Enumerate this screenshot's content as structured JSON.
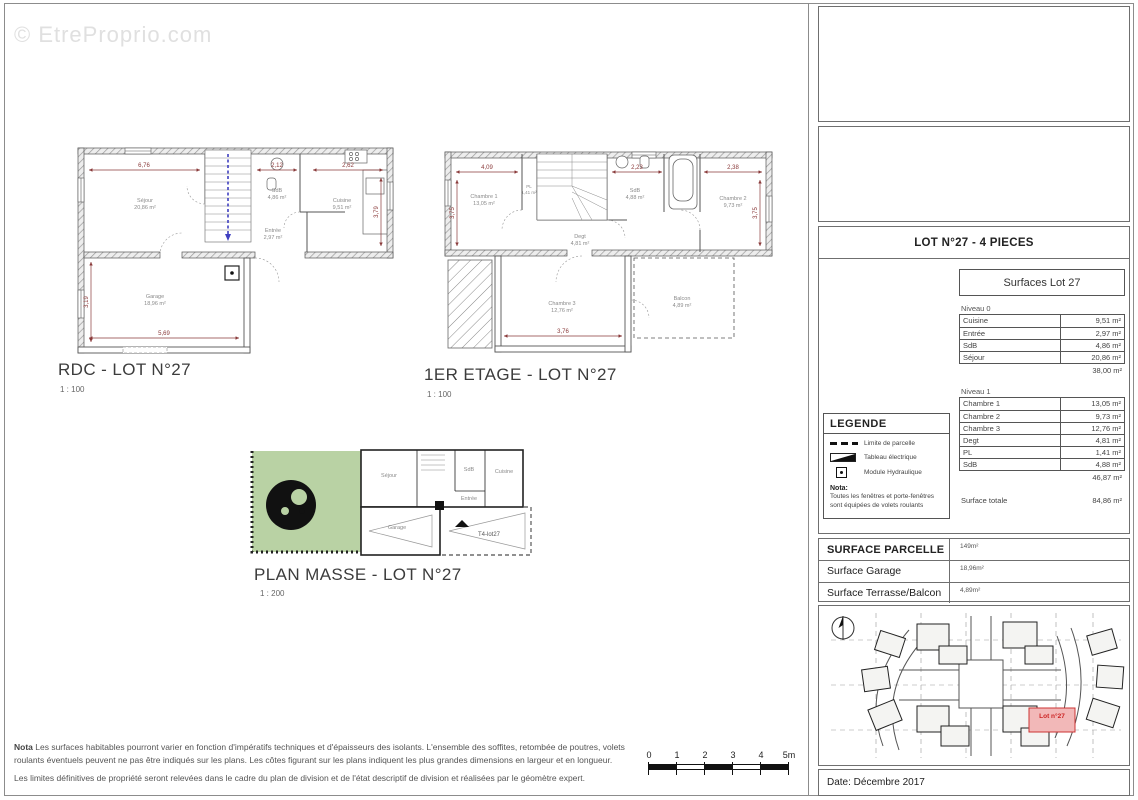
{
  "watermark": "© EtreProprio.com",
  "colors": {
    "dimension_accent": "#8a3a3a",
    "stairs_accent": "#3f3fc0",
    "garden_green": "#b9d2a4",
    "lot_highlight_fill": "#f2b8b8",
    "lot_highlight_text": "#cc2222",
    "wall_gray": "#9a9a9a"
  },
  "plans": {
    "rdc": {
      "title": "RDC - LOT N°27",
      "scale": "1 : 100",
      "rooms": [
        {
          "name": "Séjour",
          "area": "20,86 m²"
        },
        {
          "name": "SdB",
          "area": "4,86 m²"
        },
        {
          "name": "Entrée",
          "area": "2,97 m²"
        },
        {
          "name": "Cuisine",
          "area": "9,51 m²"
        },
        {
          "name": "Garage",
          "area": "18,96 m²"
        }
      ],
      "dims": [
        "6,76",
        "2,12",
        "2,62",
        "3,79",
        "3,19",
        "5,69"
      ]
    },
    "etage": {
      "title": "1ER ETAGE - LOT N°27",
      "scale": "1 : 100",
      "rooms": [
        {
          "name": "Chambre 1",
          "area": "13,05 m²"
        },
        {
          "name": "PL",
          "area": "1,41 m²"
        },
        {
          "name": "SdB",
          "area": "4,88 m²"
        },
        {
          "name": "Chambre 2",
          "area": "9,73 m²"
        },
        {
          "name": "Degt",
          "area": "4,81 m²"
        },
        {
          "name": "Chambre 3",
          "area": "12,76 m²"
        },
        {
          "name": "Balcon",
          "area": "4,89 m²"
        }
      ],
      "dims": [
        "4,09",
        "2,23",
        "2,38",
        "3,75",
        "3,75",
        "3,76"
      ]
    },
    "masse": {
      "title": "PLAN MASSE - LOT N°27",
      "scale": "1 : 200",
      "labels": [
        "Séjour",
        "SdB",
        "Cuisine",
        "Entrée",
        "Garage",
        "T4-lot27"
      ]
    }
  },
  "sidebar": {
    "lot_header": "LOT N°27 - 4 PIECES",
    "surfaces": {
      "title": "Surfaces Lot 27",
      "niveau0": {
        "label": "Niveau 0",
        "rows": [
          {
            "label": "Cuisine",
            "value": "9,51 m²"
          },
          {
            "label": "Entrée",
            "value": "2,97 m²"
          },
          {
            "label": "SdB",
            "value": "4,86 m²"
          },
          {
            "label": "Séjour",
            "value": "20,86 m²"
          }
        ],
        "subtotal": "38,00 m²"
      },
      "niveau1": {
        "label": "Niveau 1",
        "rows": [
          {
            "label": "Chambre 1",
            "value": "13,05 m²"
          },
          {
            "label": "Chambre 2",
            "value": "9,73 m²"
          },
          {
            "label": "Chambre 3",
            "value": "12,76 m²"
          },
          {
            "label": "Degt",
            "value": "4,81 m²"
          },
          {
            "label": "PL",
            "value": "1,41 m²"
          },
          {
            "label": "SdB",
            "value": "4,88 m²"
          }
        ],
        "subtotal": "46,87 m²"
      },
      "total_label": "Surface totale",
      "total_value": "84,86 m²"
    },
    "legende": {
      "title": "LEGENDE",
      "items": [
        "Limite de parcelle",
        "Tableau électrique",
        "Module Hydraulique"
      ],
      "nota_label": "Nota:",
      "nota_text": "Toutes les fenêtres et porte-fenêtres sont équipées de volets roulants"
    },
    "parcelle": {
      "rows": [
        {
          "label": "SURFACE PARCELLE",
          "value": "149m²"
        },
        {
          "label": "Surface Garage",
          "value": "18,96m²"
        },
        {
          "label": "Surface Terrasse/Balcon",
          "value": "4,89m²"
        }
      ]
    },
    "sitemap": {
      "lot_label": "Lot n°27"
    },
    "date": "Date: Décembre 2017"
  },
  "notes": {
    "label": "Nota",
    "para1": "Les surfaces habitables pourront varier en fonction d'impératifs techniques et d'épaisseurs des isolants. L'ensemble des soffites, retombée de poutres, volets roulants éventuels peuvent ne pas être indiqués sur les plans. Les côtes figurant sur les plans indiquent les plus grandes dimensions en largeur et en longueur.",
    "para2": "Les limites définitives de propriété seront relevées dans le cadre du plan de division et de l'état descriptif de division et réalisées par le géomètre expert."
  },
  "scalebar": {
    "ticks": [
      "0",
      "1",
      "2",
      "3",
      "4",
      "5m"
    ]
  }
}
